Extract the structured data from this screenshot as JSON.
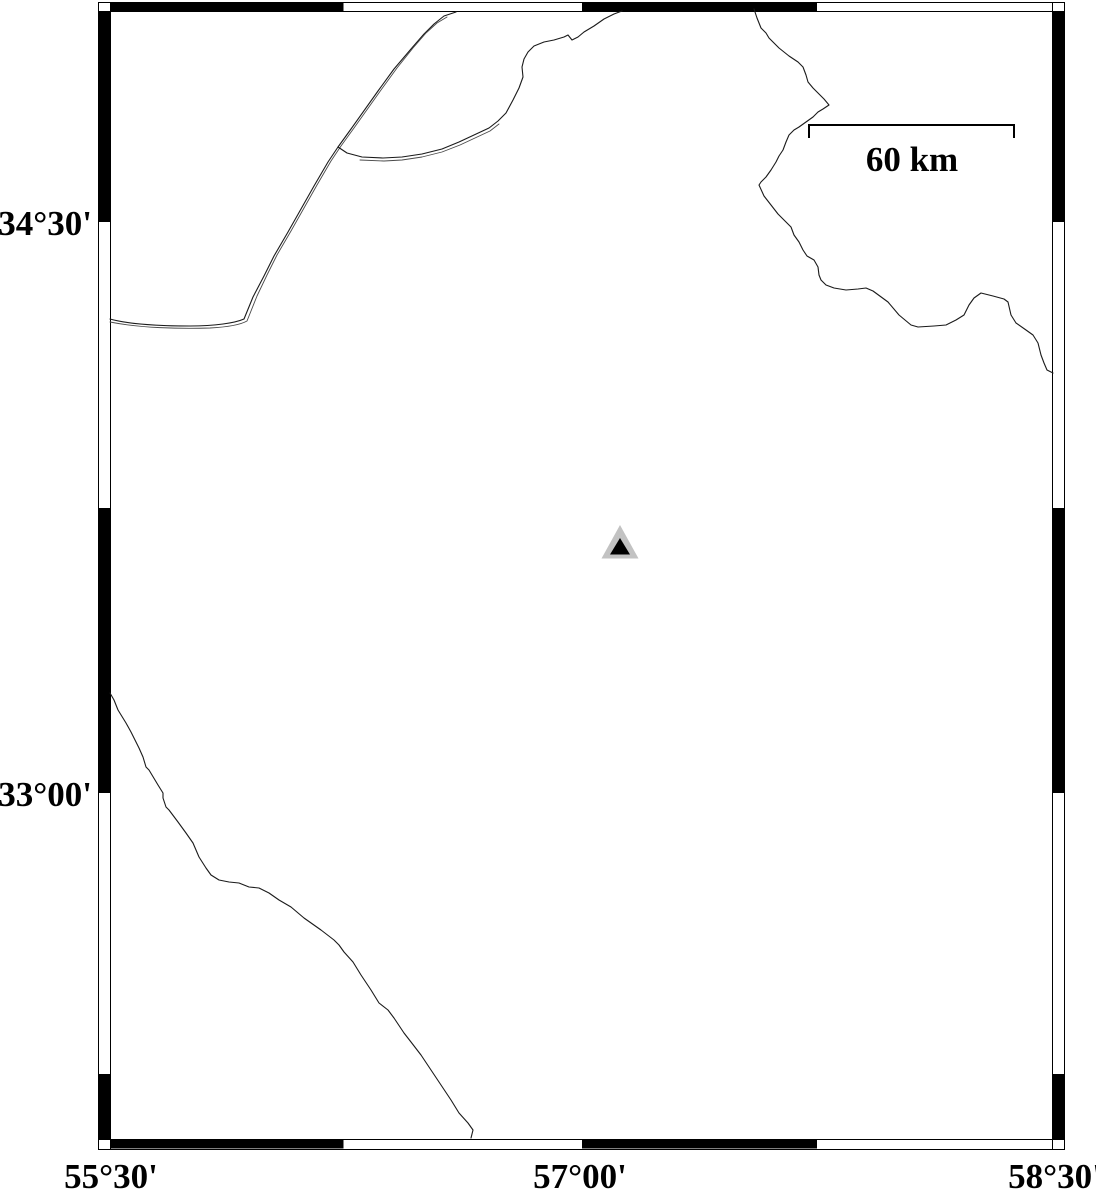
{
  "map": {
    "background_color": "#ffffff",
    "frame_color": "#000000",
    "line_color": "#1a1a1a",
    "axes": {
      "left_labels": [
        "34°30'",
        "33°00'"
      ],
      "bottom_labels": [
        "55°30'",
        "57°00'",
        "58°30'"
      ]
    },
    "scale_bar": {
      "label": "60 km"
    },
    "marker": {
      "symbol": "triangle",
      "outer_color": "#c2c2c2",
      "inner_color": "#000000",
      "outer_points": "620,525 601.5,558.5 638.5,558.5",
      "inner_points": "620,538 610,554.5 630,554.5"
    },
    "features": {
      "nw_border_main": {
        "d": "M110,319 C128,324 160,326 190,326 C215,326 235,323 244,319 L253,297 L264,276 L274,256 L288,232 L301,209 L314,186 L328,162 L338,147 L351,129 L378,91 L394,69 L411,49 L424,34 L434,24 L444,16 L456,12"
      },
      "nw_border_twin": {
        "d": "M110,322 C140,328 180,329 210,328 C228,327 240,325 247,321 L257,296 L267,275 L277,255 L291,231 L304,208 L317,185 L331,161 L341,146 L354,128 L381,90 L397,68 L413,48 L426,33 L437,23 L447,17"
      },
      "n_coast_main": {
        "d": "M338,147 L347,153 L362,157 L383,158 L402,157 L422,154 L442,149 L459,142 L474,135 L489,128 L498,121 L506,113 L513,100 L519,88 L523,77 L522,67 L524,59 L528,52 L534,46 L544,42 L554,40 L564,37 L568,35 L572,40 L578,37 L584,32 L594,26 L604,19 L614,14 L622,11"
      },
      "n_coast_twin": {
        "d": "M360,160 L384,161 L402,160 L422,157 L442,152 L460,145 L475,138 L490,131 L499,124"
      },
      "ne_border": {
        "d": "M754,9 L757,18 L761,28 L766,33 L769,38 L774,43 L779,48 L789,56 L798,62 L803,67 L806,75 L808,82 L813,88 L818,93 L824,99 L829,105 L823,109 L818,112 L813,117 L806,122 L799,127 L794,130 L789,135 L786,142 L783,150 L779,156 L776,162 L771,170 L766,177 L761,182 L759,185 L764,196 L771,205 L778,214 L786,222 L791,227 L794,235 L799,242 L803,250 L807,256 L814,260 L818,267 L819,275 L821,280 L826,285 L834,288 L846,290 L858,289 L866,288 L873,291 L888,302 L899,315 L911,325 L918,327 L934,326 L946,325 L956,320 L964,315 L969,305 L974,298 L981,293 L993,296 L1004,299 L1008,302 L1011,315 L1016,323 L1026,330 L1033,335 L1038,343 L1041,355 L1044,363 L1047,370 L1053,373"
      },
      "sw_border": {
        "d": "M110,693 L114,700 L118,710 L126,723 L131,732 L139,748 L143,757 L146,767 L149,770 L158,785 L163,793 L163,798 L166,807 L169,810 L178,822 L186,833 L193,843 L199,857 L206,868 L211,875 L219,880 L229,882 L239,883 L249,887 L259,888 L269,893 L279,900 L291,907 L304,918 L321,930 L334,940 L339,945 L344,952 L353,962 L361,975 L371,990 L379,1003 L388,1010 L394,1018 L404,1033 L411,1042 L421,1055 L431,1070 L441,1085 L451,1100 L459,1113 L468,1123 L473,1130 L471,1138"
      }
    }
  }
}
